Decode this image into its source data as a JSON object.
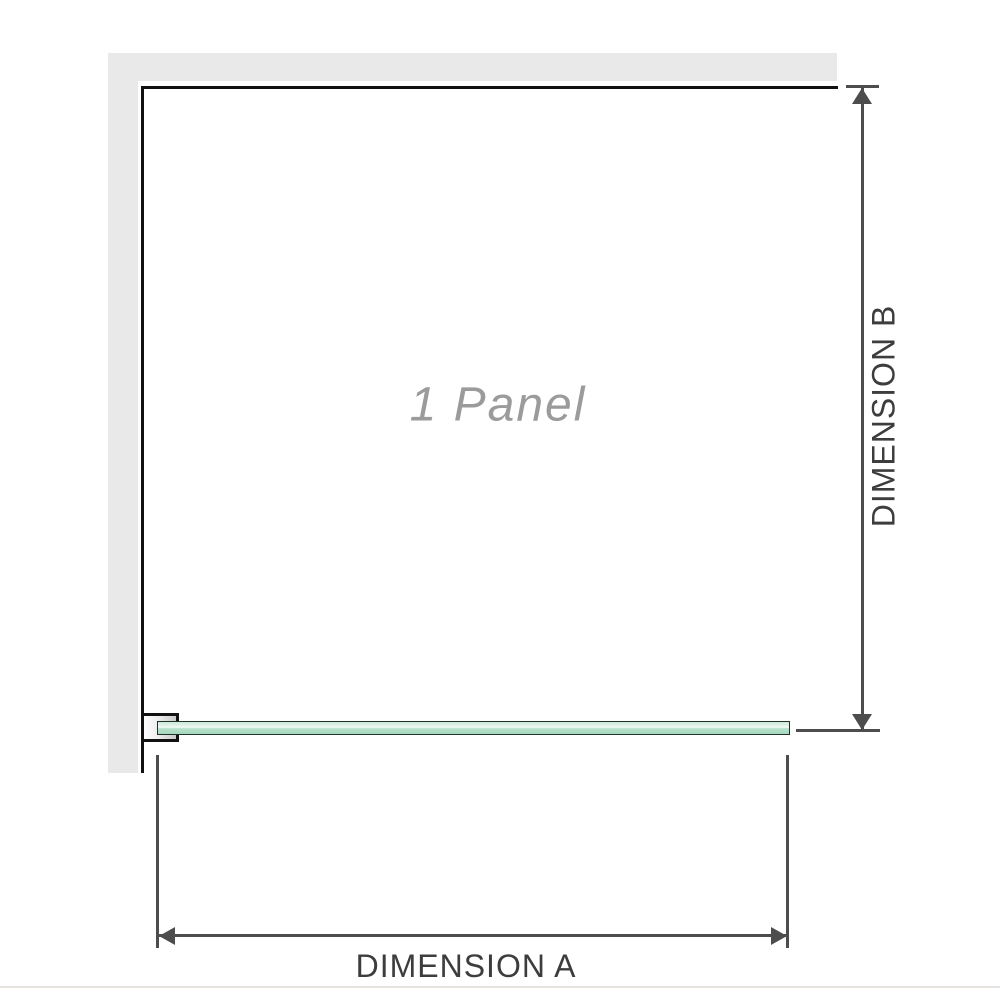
{
  "diagram": {
    "title": "1 Panel shower screen dimension diagram",
    "panel_label": "1 Panel",
    "dimension_a": {
      "label": "DIMENSION A",
      "orientation": "horizontal",
      "measures": "glass panel width"
    },
    "dimension_b": {
      "label": "DIMENSION B",
      "orientation": "vertical",
      "measures": "glass panel height"
    },
    "parts": {
      "wall": "grey L-shaped wall (top + left)",
      "glass": "green glass panel shown in plan view",
      "bracket": "wall-mounted U-channel bracket holding glass"
    }
  },
  "colors": {
    "wall_fill": "#e9e9e9",
    "outline": "#111111",
    "dimension_lines": "#4d4d4d",
    "dimension_text": "#3d3d3d",
    "panel_label_text": "#9b9b9b",
    "glass_light": "#dff2e8",
    "glass_mid": "#a5d8bd",
    "glass_edge": "#1f3329"
  }
}
